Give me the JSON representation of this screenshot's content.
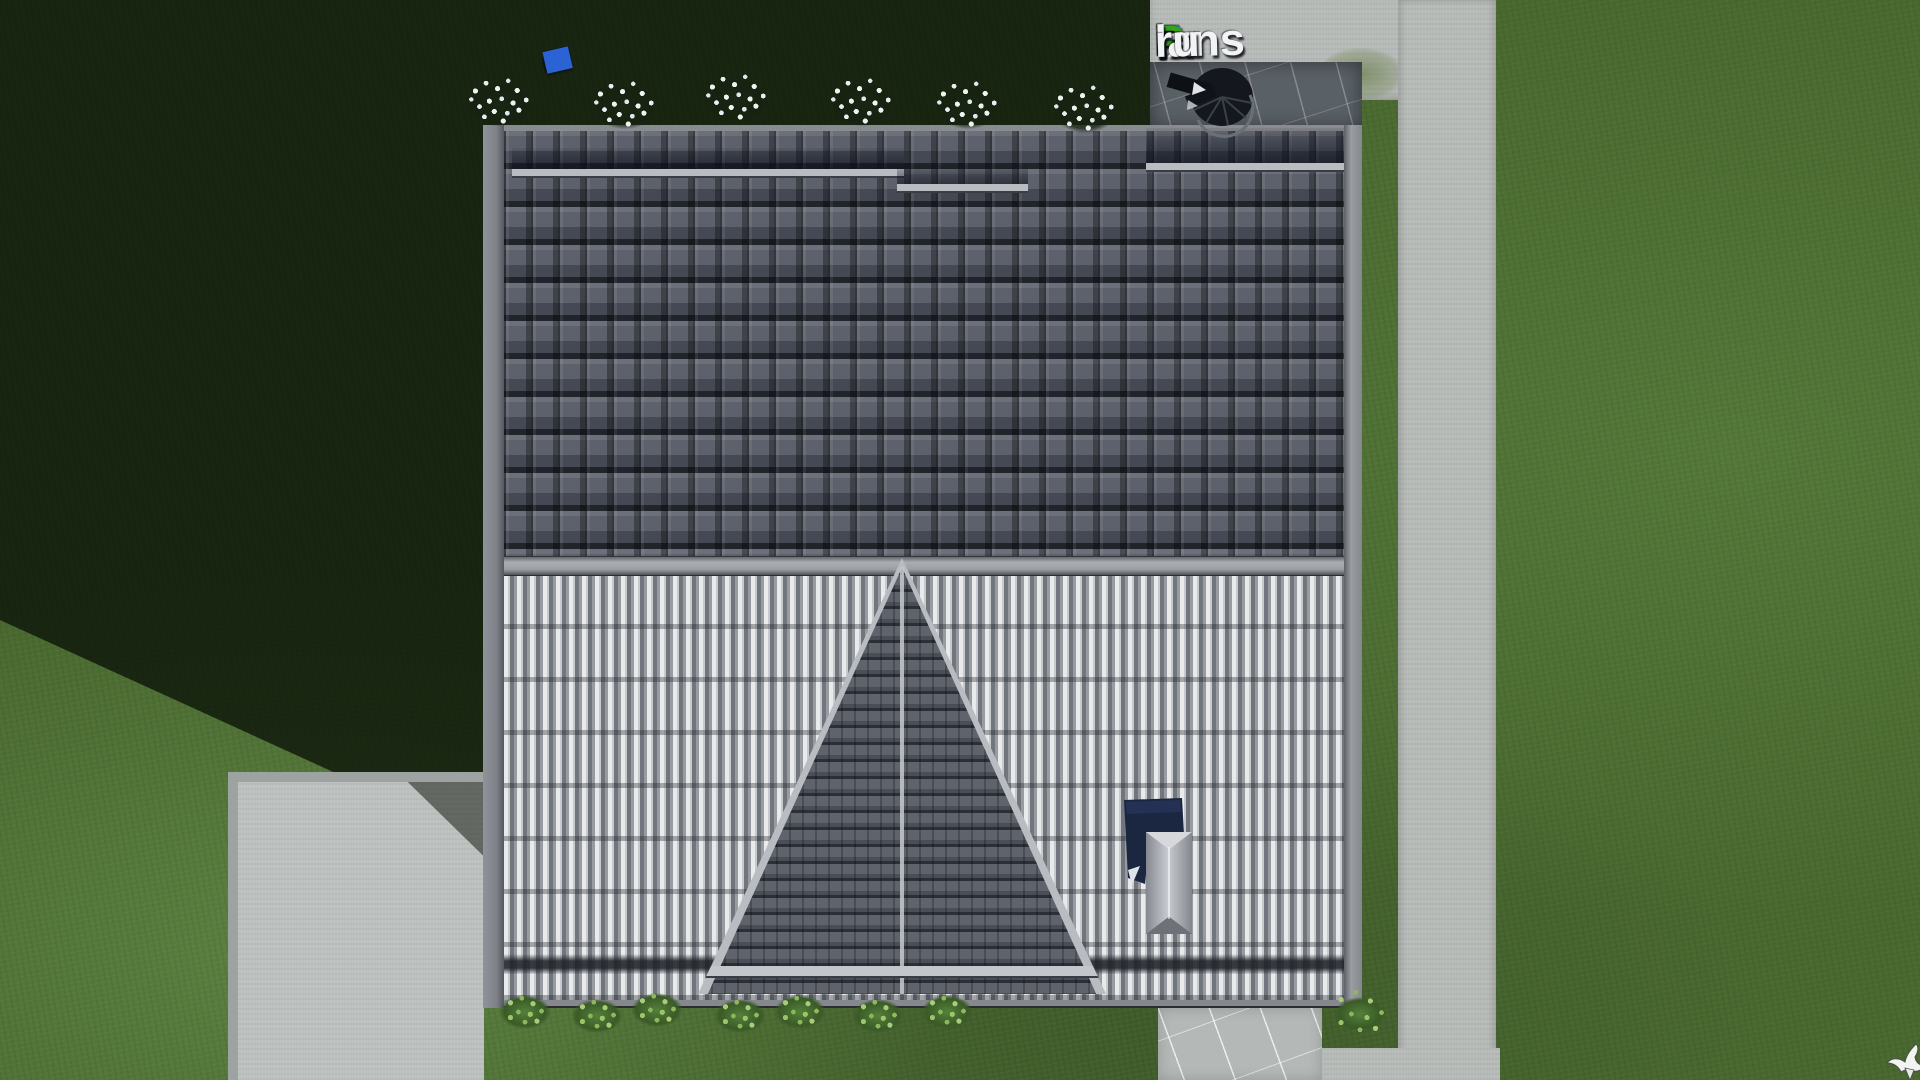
{
  "meta": {
    "type": "3d-architectural-render",
    "view": "top-down-roof-plan"
  },
  "watermark": {
    "text": "FixPlans.ru",
    "segments": [
      {
        "text": "F",
        "color": "#2e6fd6"
      },
      {
        "text": "ix",
        "color": "#f2f3f5"
      },
      {
        "text": "P",
        "color": "#36a417"
      },
      {
        "text": "lans",
        "color": "#f2f3f5"
      },
      {
        "text": ".",
        "color": "#2e6fd6"
      },
      {
        "text": "ru",
        "color": "#f2f3f5"
      }
    ]
  },
  "scene": {
    "palette": {
      "grass": "#49682f",
      "grass_shadow": "#1d2a16",
      "concrete": "#b7bbb8",
      "marble_dark": "#596066",
      "marble_light": "#b4b8b6",
      "roof_dark_tiles": "#565a64",
      "roof_light_ribbed": "#a7abb0",
      "ridge_trim": "#a6a9ad",
      "gable_tiles": "#4b4f58",
      "chimney_flashing": "#1c2742",
      "chimney_cap": "#aeb2b9",
      "ruler_blue": "#2b63d4",
      "ruler_green": "#33a42b",
      "flower_white": "#eef3ef",
      "bird_white": "#f2f4f2"
    },
    "objects": [
      "lawn",
      "building-shadow",
      "upper-roof-slope-dark-tiles",
      "ridge-cap",
      "lower-roof-slope-ribbed",
      "gable-triangle",
      "chimney",
      "spiral-staircase",
      "top-patio",
      "right-walkway",
      "bottom-left-pad",
      "bottom-right-marble-patio",
      "folding-ruler",
      "flower-bushes",
      "green-bushes",
      "white-bird",
      "snow-guards"
    ],
    "vegetation": {
      "flower_bushes": [
        [
          500,
          103
        ],
        [
          625,
          106
        ],
        [
          737,
          99
        ],
        [
          862,
          103
        ],
        [
          968,
          106
        ],
        [
          1085,
          110
        ]
      ],
      "green_bushes": [
        [
          525,
          1012
        ],
        [
          597,
          1016
        ],
        [
          657,
          1010
        ],
        [
          740,
          1016
        ],
        [
          800,
          1012
        ],
        [
          878,
          1016
        ],
        [
          947,
          1012
        ],
        [
          1360,
          1014,
          86,
          72
        ]
      ]
    },
    "ruler_segments": [
      {
        "c": "#e9ecee",
        "w": 24
      },
      {
        "c": "#e9ecee",
        "w": 24
      },
      {
        "c": "#2b63d4",
        "w": 11
      },
      {
        "c": "#e9ecee",
        "w": 21
      },
      {
        "c": "#e9ecee",
        "w": 23
      },
      {
        "c": "#e9ecee",
        "w": 15
      },
      {
        "c": "#e9ecee",
        "w": 8
      },
      {
        "c": "#33a42b",
        "w": 22
      },
      {
        "c": "#dde1e4",
        "w": 23
      },
      {
        "c": "#33a42b",
        "w": 9
      },
      {
        "c": "#2b63d4",
        "w": 26,
        "h": 22
      }
    ]
  }
}
